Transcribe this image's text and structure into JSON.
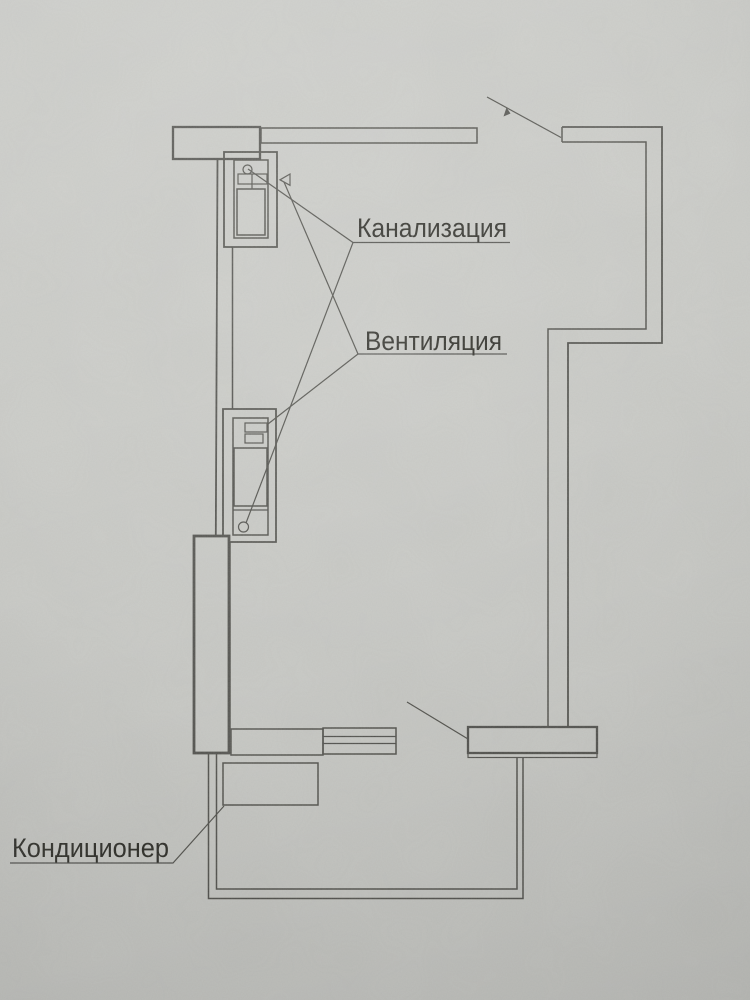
{
  "plan": {
    "labels": {
      "sewerage": "Канализация",
      "ventilation": "Вентиляция",
      "air_conditioner": "Кондиционер"
    }
  },
  "colors": {
    "paper": "#c9cac6",
    "ink": "#4a4a44",
    "ink-text": "#22221d"
  }
}
